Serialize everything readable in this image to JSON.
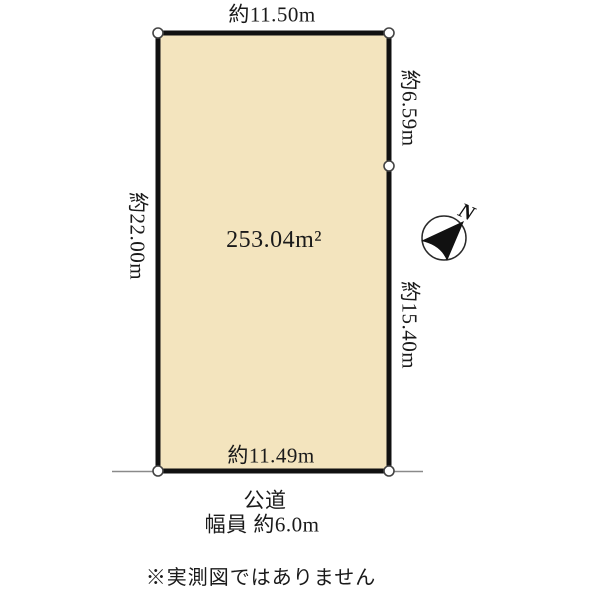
{
  "diagram": {
    "area_label": "253.04m²",
    "dimensions": {
      "top": "約11.50m",
      "left": "約22.00m",
      "right_upper": "約6.59m",
      "right_lower": "約15.40m",
      "bottom": "約11.49m"
    },
    "road": {
      "name": "公道",
      "width": "幅員 約6.0m"
    },
    "compass": {
      "north": "N"
    },
    "note": "※実測図ではありません",
    "colors": {
      "plot_fill": "#F3E4BE",
      "plot_border": "#111111",
      "boundary_point_fill": "#FFFFFF",
      "boundary_point_stroke": "#444444",
      "road_line": "#8A8A8A",
      "text": "#1A1A1A"
    }
  }
}
